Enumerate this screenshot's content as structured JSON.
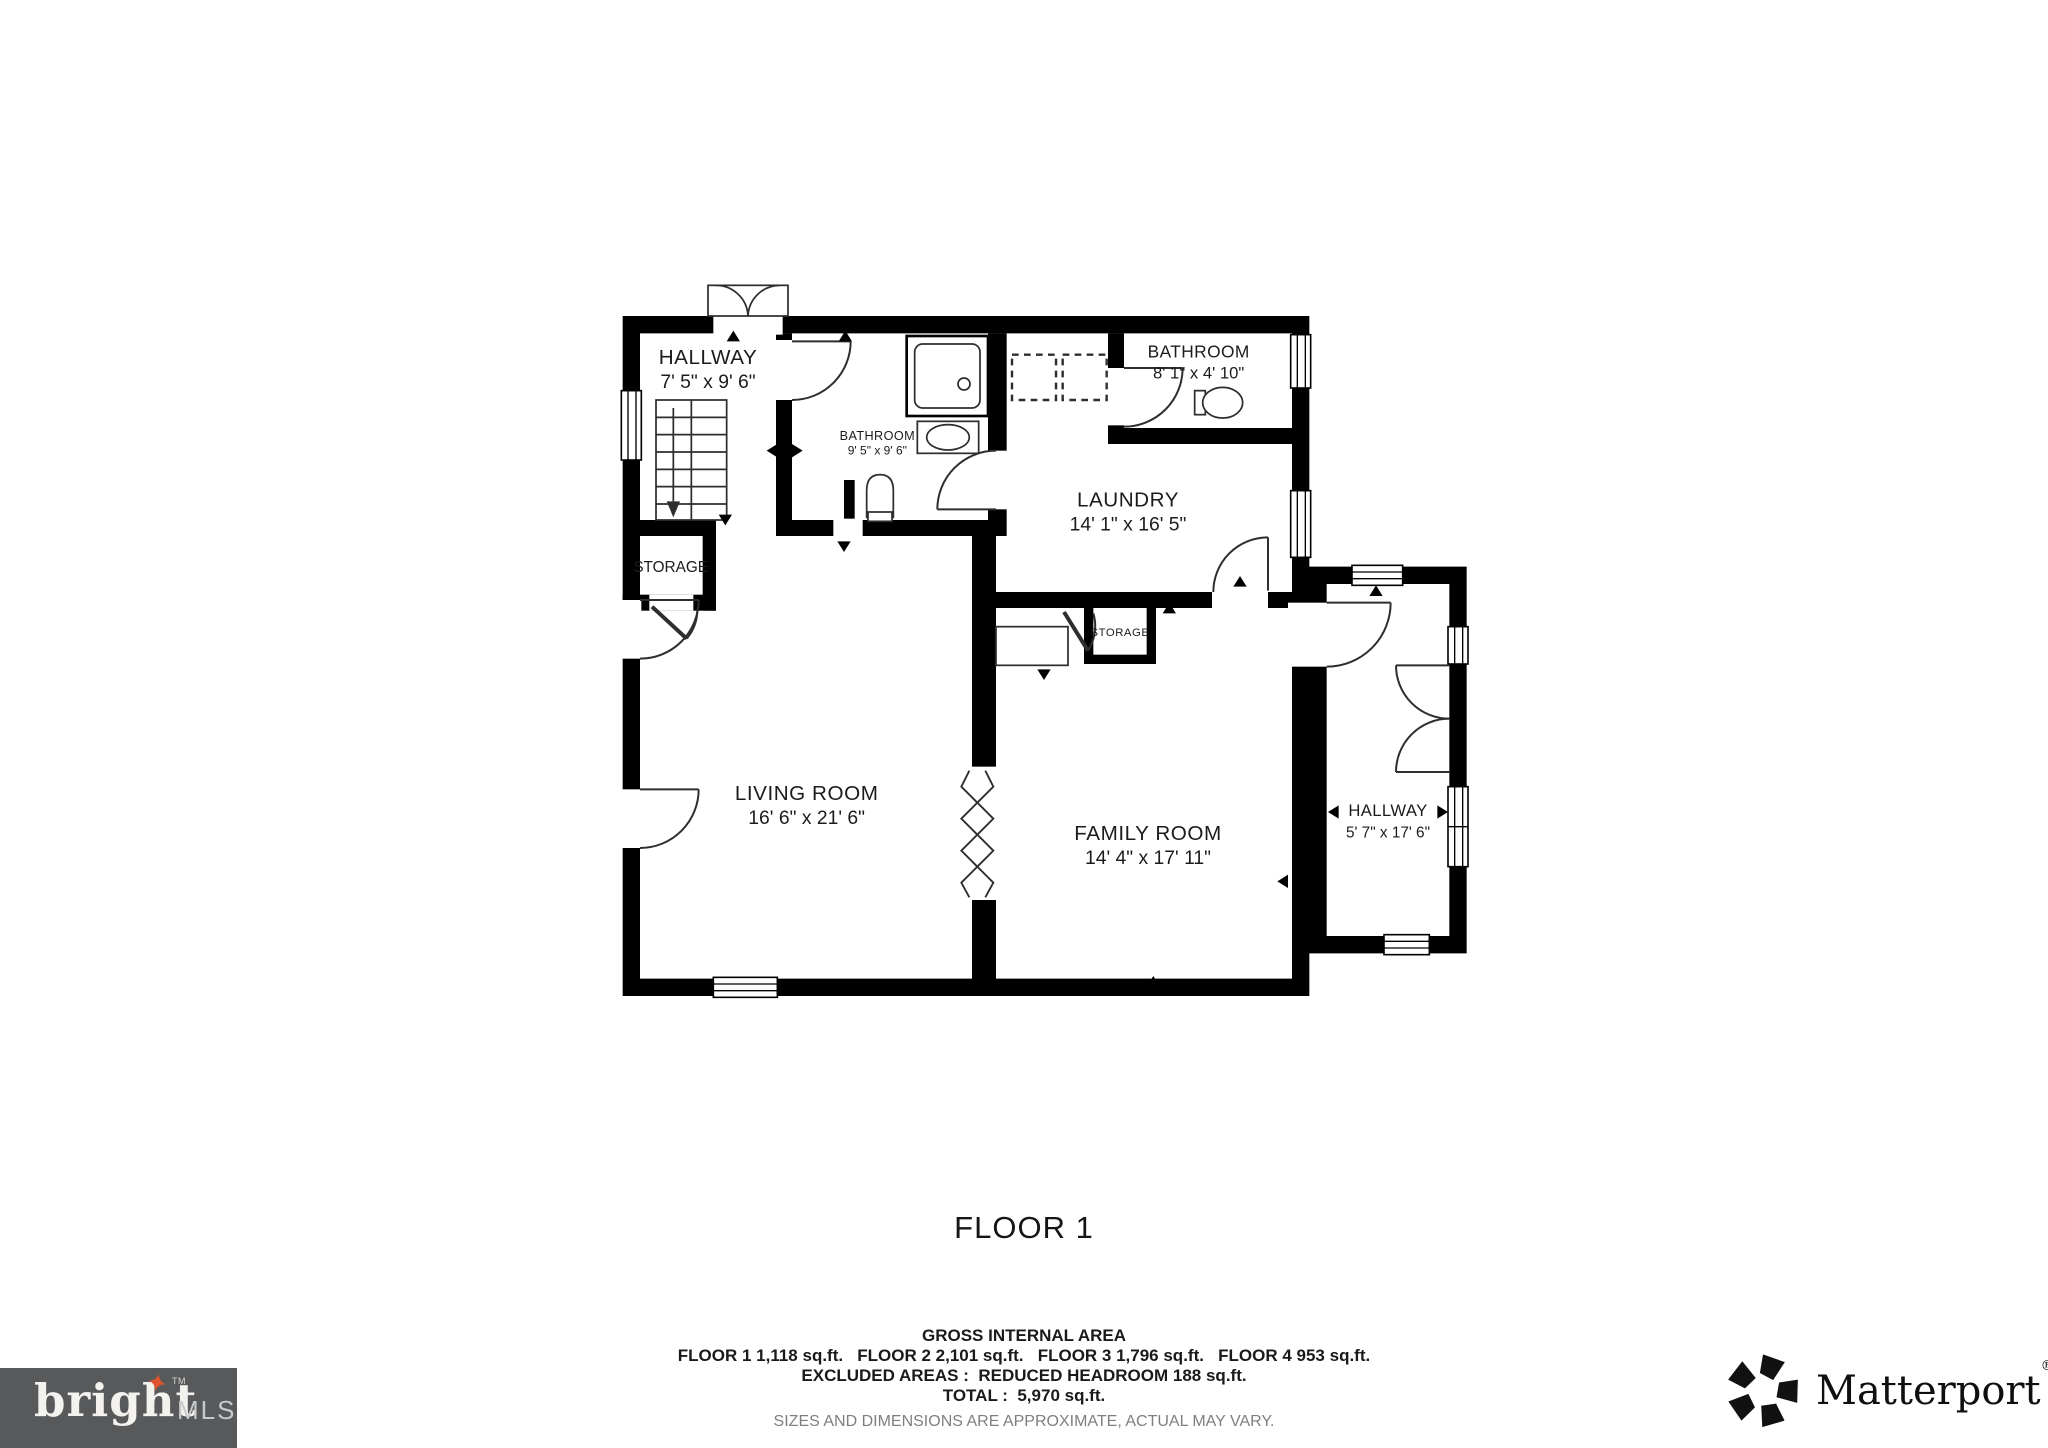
{
  "page": {
    "title": "FLOOR 1"
  },
  "plan": {
    "rooms": [
      {
        "id": "hallway-1",
        "name": "HALLWAY",
        "dims": "7' 5\" x 9' 6\""
      },
      {
        "id": "bathroom-1",
        "name": "BATHROOM",
        "dims": "9' 5\" x 9' 6\""
      },
      {
        "id": "bathroom-2",
        "name": "BATHROOM",
        "dims": "8' 1\" x 4' 10\""
      },
      {
        "id": "laundry",
        "name": "LAUNDRY",
        "dims": "14' 1\" x 16' 5\""
      },
      {
        "id": "storage-1",
        "name": "STORAGE",
        "dims": ""
      },
      {
        "id": "storage-2",
        "name": "STORAGE",
        "dims": ""
      },
      {
        "id": "living-room",
        "name": "LIVING ROOM",
        "dims": "16' 6\" x 21' 6\""
      },
      {
        "id": "family-room",
        "name": "FAMILY ROOM",
        "dims": "14' 4\" x 17' 11\""
      },
      {
        "id": "hallway-2",
        "name": "HALLWAY",
        "dims": "5' 7\" x 17' 6\""
      }
    ]
  },
  "footer": {
    "gross_title": "GROSS INTERNAL AREA",
    "floors_line": "FLOOR 1 1,118 sq.ft.   FLOOR 2 2,101 sq.ft.   FLOOR 3 1,796 sq.ft.   FLOOR 4 953 sq.ft.",
    "excluded_line": "EXCLUDED AREAS :  REDUCED HEADROOM 188 sq.ft.",
    "total_line": "TOTAL :  5,970 sq.ft.",
    "disclaimer": "SIZES AND DIMENSIONS ARE APPROXIMATE, ACTUAL MAY VARY."
  },
  "logos": {
    "bright": {
      "word": "bright",
      "suffix": "MLS",
      "tm": "TM",
      "star_glyph": "✦"
    },
    "matterport": {
      "word": "Matterport",
      "reg": "®"
    }
  },
  "colors": {
    "wall": "#000000",
    "bright_logo_bg": "#58595b",
    "bright_star_accent": "#e1532e",
    "disclaimer_gray": "#7f7f7f"
  }
}
